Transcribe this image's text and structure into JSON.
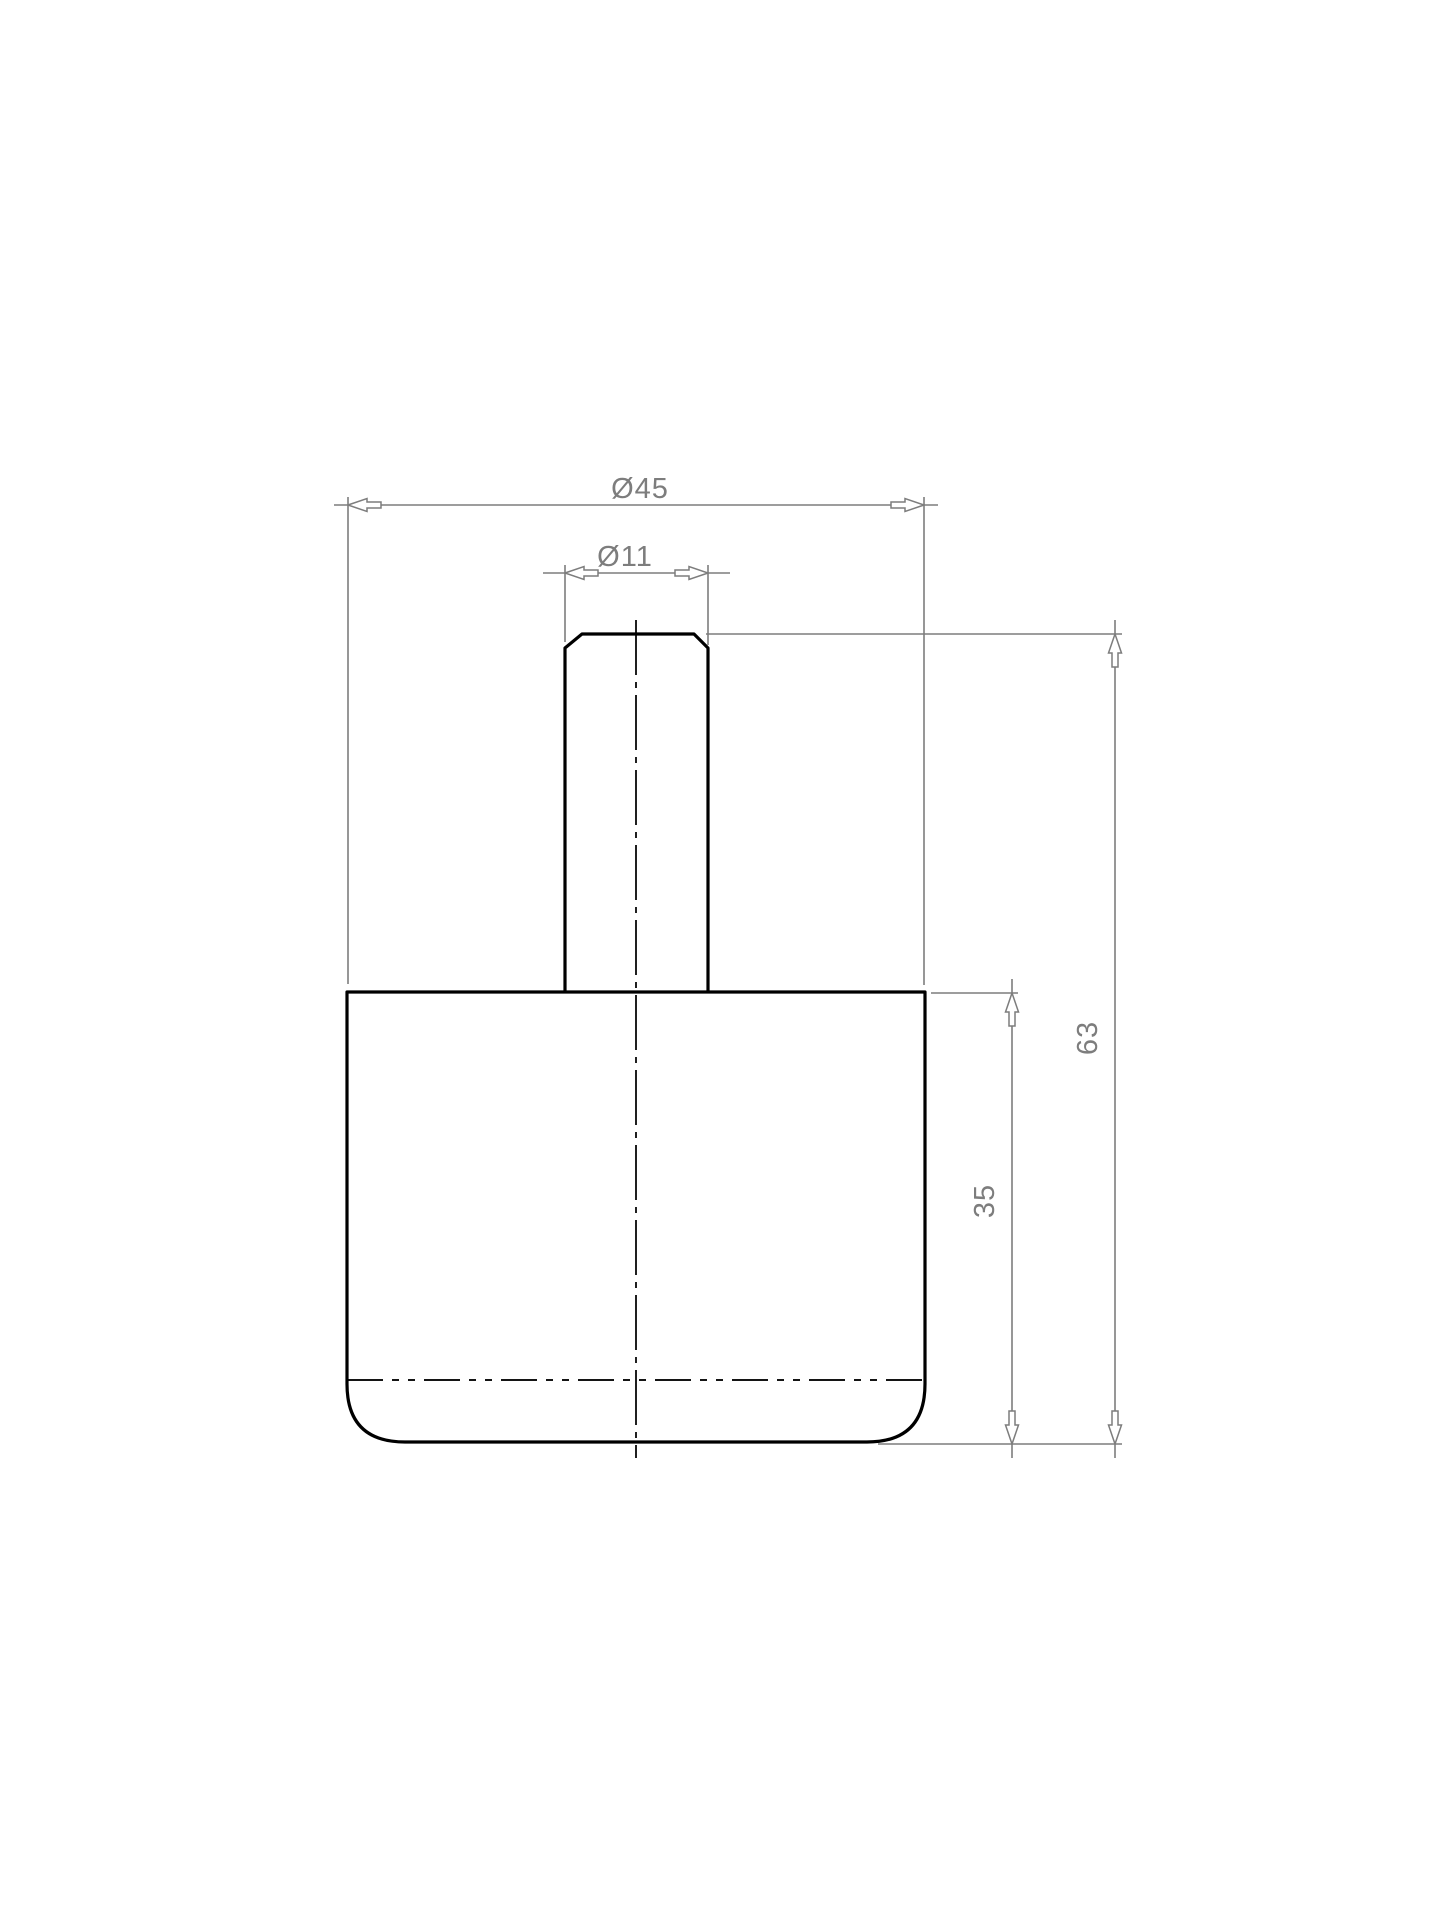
{
  "drawing": {
    "background_color": "#ffffff",
    "outline_color": "#000000",
    "dimension_color": "#7d7d7d",
    "dimensions": {
      "outer_diameter": {
        "label": "Ø45",
        "value": 45
      },
      "stem_diameter": {
        "label": "Ø11",
        "value": 11
      },
      "overall_height": {
        "label": "63",
        "value": 63
      },
      "body_height": {
        "label": "35",
        "value": 35
      }
    }
  }
}
